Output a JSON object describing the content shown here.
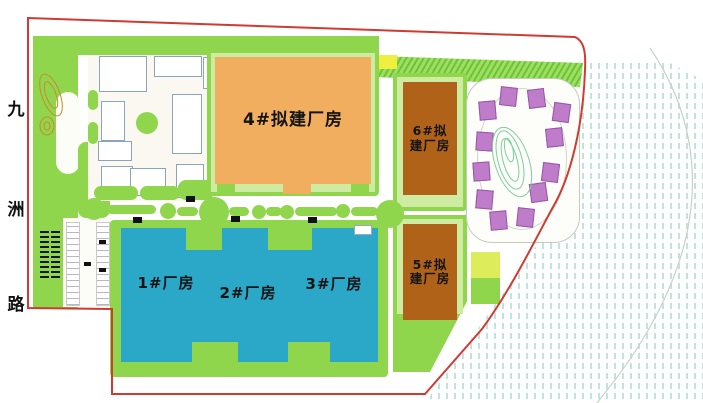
{
  "road": {
    "name": "九洲路",
    "chars": [
      "九",
      "洲",
      "路"
    ]
  },
  "buildings": {
    "b4": {
      "label": "4#拟建厂房"
    },
    "b6": {
      "line1": "6#拟",
      "line2": "建厂房"
    },
    "b5": {
      "line1": "5#拟",
      "line2": "建厂房"
    },
    "b1": {
      "label": "1#厂房"
    },
    "b2": {
      "label": "2#厂房"
    },
    "b3": {
      "label": "3#厂房"
    }
  },
  "colors": {
    "site_green": "#8fd64d",
    "pale_green": "#cdeca2",
    "building_orange": "#f0ae5e",
    "building_brown": "#b06318",
    "building_teal": "#2ba7c7",
    "building_purple": "#bf7cc8",
    "boundary_red": "#cf3b33",
    "hatch_blue": "#bfe4de",
    "highlight_yellow": "#f0ee3e"
  }
}
